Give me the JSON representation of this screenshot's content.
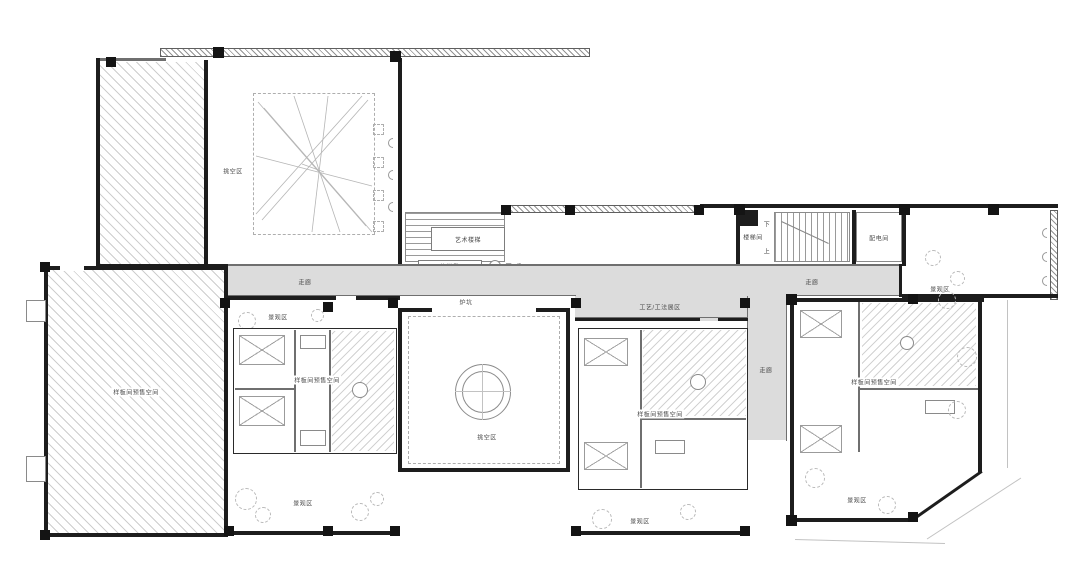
{
  "drawing": {
    "type": "architectural-floor-plan",
    "floor": "show-flat exhibition level",
    "labels": {
      "void_area": "挑空区",
      "art_stair": "艺术楼梯",
      "shoe_bench": "换鞋凳",
      "down_steps": "下3步",
      "stair_room": "楼梯间",
      "up": "上",
      "down": "下",
      "power_room": "配电间",
      "corridor": "走廊",
      "craft_zone": "工艺/工法展区",
      "fire_pit": "炉坑",
      "showroom": "样板间预售空间",
      "landscape": "景观区"
    },
    "symbols": {
      "tree": "tree-symbol",
      "column": "structural-column",
      "stairs": "stair-flight",
      "circle_feature": "circular-void-feature"
    },
    "colors": {
      "background": "#ffffff",
      "corridor_fill": "#dcdcdc",
      "wall": "#1d1d1d",
      "line": "#6f6f6f",
      "tree_outline": "#b9b9b9"
    }
  }
}
